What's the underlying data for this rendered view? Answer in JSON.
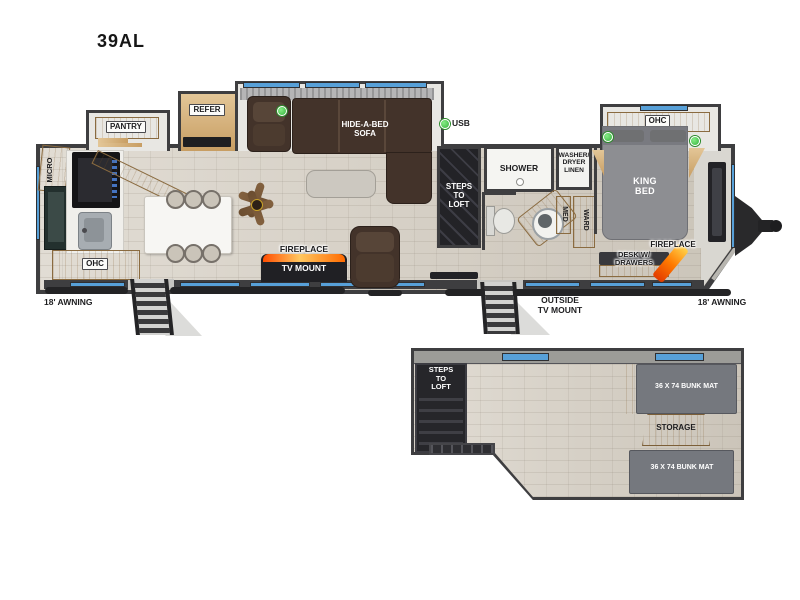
{
  "title": "39AL",
  "legend": {
    "usb": "USB"
  },
  "exterior": {
    "awning_left": "18' AWNING",
    "awning_right": "18' AWNING",
    "outside_tv_mount": "OUTSIDE\nTV MOUNT"
  },
  "kitchen": {
    "micro": "MICRO",
    "pantry": "PANTRY",
    "refer": "REFER",
    "ohc": "OHC"
  },
  "living": {
    "sofa": "HIDE-A-BED\nSOFA",
    "fireplace": "FIREPLACE",
    "tv_mount": "TV MOUNT",
    "steps_to_loft": "STEPS\nTO\nLOFT"
  },
  "bathroom": {
    "shower": "SHOWER",
    "washer_dryer": "WASHER/\nDRYER\nLINEN",
    "med": "MED",
    "ward": "WARD"
  },
  "bedroom": {
    "ohc": "OHC",
    "king_bed": "KING\nBED",
    "fireplace": "FIREPLACE",
    "desk": "DESK W/\nDRAWERS"
  },
  "loft": {
    "steps_to_loft": "STEPS\nTO\nLOFT",
    "bunk_top": "36 X 74 BUNK MAT",
    "storage": "STORAGE",
    "bunk_bottom": "36 X 74 BUNK MAT"
  },
  "colors": {
    "wall": "#3e3e40",
    "floor": "#d6cfc3",
    "wood": "#d3b284",
    "slide_interior": "#e8e7e3",
    "sofa_brown": "#43332a",
    "bed_gray": "#8d8e92",
    "mat_gray": "#75787e",
    "accent_blue": "#57a0d8",
    "usb_green": "#35b33c",
    "flame_orange": "#ff6a00"
  }
}
